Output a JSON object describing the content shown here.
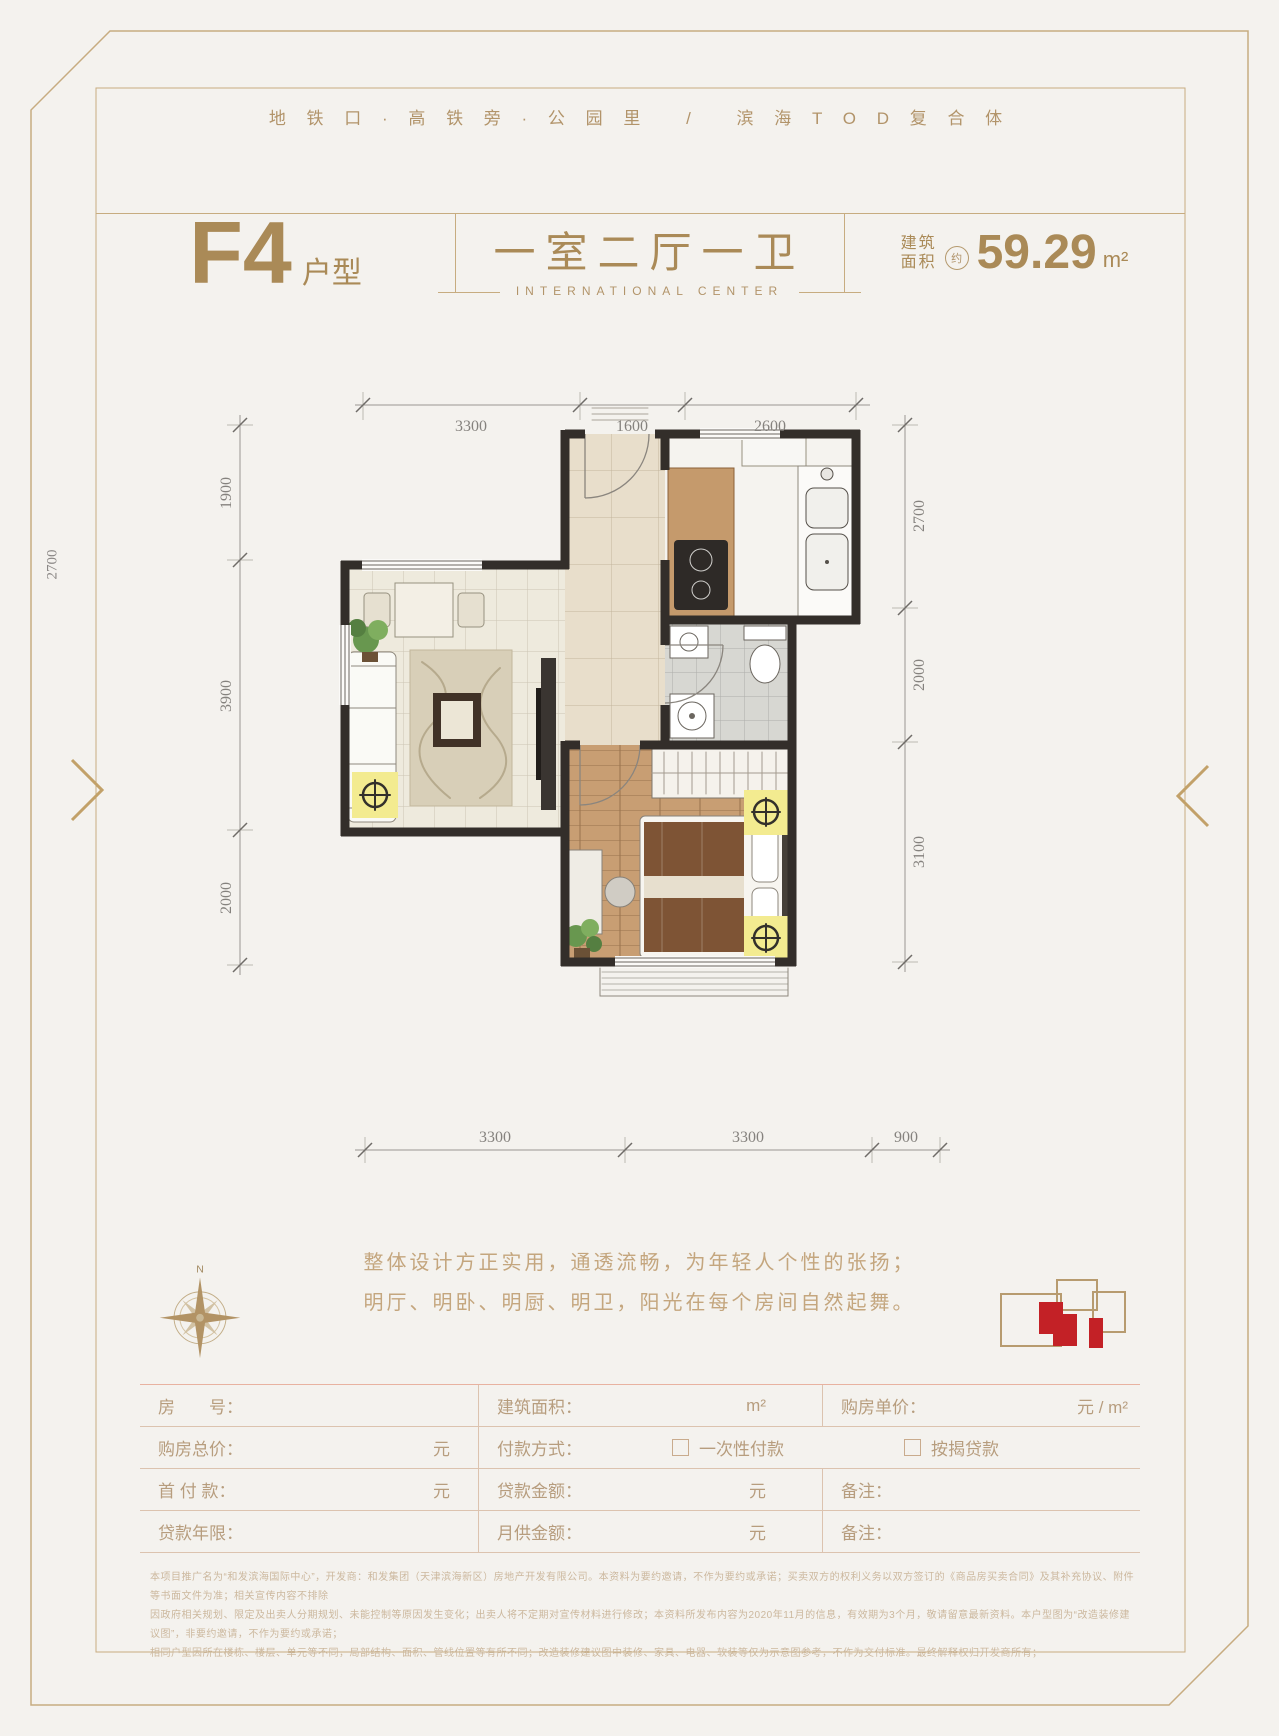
{
  "header": {
    "tagline": "地 铁 口 · 高 铁 旁 · 公 园 里 　/　 滨 海 T O D 复 合 体",
    "unit_code": "F4",
    "unit_suffix": "户型",
    "layout": "一室二厅一卫",
    "subtitle": "INTERNATIONAL CENTER",
    "area_label1": "建筑",
    "area_label2": "面积",
    "area_approx": "约",
    "area_value": "59.29",
    "area_unit": "m²"
  },
  "plan": {
    "dims_top": [
      "3300",
      "1600",
      "2600"
    ],
    "dims_left": [
      "1900",
      "3900",
      "2000"
    ],
    "dims_right": [
      "2700",
      "2000",
      "3100"
    ],
    "dims_bottom": [
      "3300",
      "3300",
      "900"
    ],
    "dim_far_left": "2700",
    "compass": "N"
  },
  "description": {
    "line1": "整体设计方正实用，通透流畅，为年轻人个性的张扬；",
    "line2": "明厅、明卧、明厨、明卫，阳光在每个房间自然起舞。"
  },
  "form": {
    "room_label": "房　　号：",
    "area_label": "建筑面积：",
    "area_unit": "m²",
    "unit_price_label": "购房单价：",
    "unit_price_unit": "元 / m²",
    "total_label": "购房总价：",
    "total_unit": "元",
    "payment_label": "付款方式：",
    "payment_opt1": "一次性付款",
    "payment_opt2": "按揭贷款",
    "down_label": "首 付 款：",
    "down_unit": "元",
    "loan_amount_label": "贷款金额：",
    "loan_amount_unit": "元",
    "note1_label": "备注：",
    "loan_years_label": "贷款年限：",
    "monthly_label": "月供金额：",
    "monthly_unit": "元",
    "note2_label": "备注："
  },
  "fineprint": {
    "line1": "本项目推广名为“和发滨海国际中心”，开发商：和发集团（天津滨海新区）房地产开发有限公司。本资料为要约邀请，不作为要约或承诺；买卖双方的权利义务以双方签订的《商品房买卖合同》及其补充协议、附件等书面文件为准；相关宣传内容不排除",
    "line2": "因政府相关规划、限定及出卖人分期规划、未能控制等原因发生变化；出卖人将不定期对宣传材料进行修改；本资料所发布内容为2020年11月的信息，有效期为3个月，敬请留意最新资料。本户型图为“改造装修建议图”，非要约邀请，不作为要约或承诺；",
    "line3": "相同户型因所在楼栋、楼层、单元等不同，局部结构、面积、管线位置等有所不同；改造装修建议图中装修、家具、电器、软装等仅为示意图参考，不作为交付标准。最终解释权归开发商所有；"
  },
  "colors": {
    "gold": "#c7ac80",
    "accent_tan": "#aa8a57",
    "wall": "#332e2a",
    "highlight_red": "#c32126",
    "spotlight_yellow": "#f3eb90"
  }
}
